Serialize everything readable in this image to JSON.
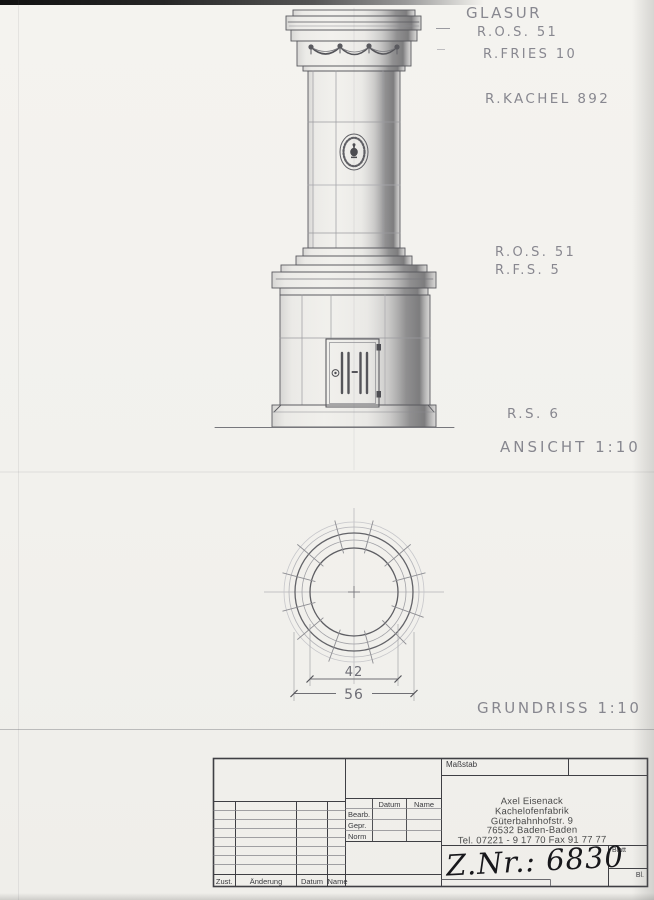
{
  "annotations": {
    "glasur": "GLASUR",
    "ros_top": "R.O.S. 51",
    "r_fries": "R.FRIES 10",
    "r_kachel": "R.KACHEL 892",
    "ros_mid": "R.O.S. 51",
    "rfs": "R.F.S. 5",
    "rs6": "R.S. 6",
    "ansicht": "ANSICHT 1:10",
    "grundriss": "GRUNDRISS 1:10"
  },
  "plan_dimensions": {
    "inner_diameter": "42",
    "outer_diameter": "56"
  },
  "title_block": {
    "massstab": "Maßstab",
    "header_datum": "Datum",
    "header_name": "Name",
    "bearb": "Bearb.",
    "gepr": "Gepr.",
    "norm": "Norm",
    "zust": "Zust.",
    "aenderung": "Änderung",
    "rev_datum": "Datum",
    "rev_name": "Name",
    "company_line1": "Axel Eisenack",
    "company_line2": "Kachelofenfabrik",
    "company_line3": "Güterbahnhofstr. 9",
    "company_line4": "76532 Baden-Baden",
    "company_line5": "Tel. 07221 - 9 17 70  Fax 91 77 77",
    "blatt": "Blatt",
    "bl": "Bl.",
    "drawing_number": "Z.Nr.: 6830"
  }
}
